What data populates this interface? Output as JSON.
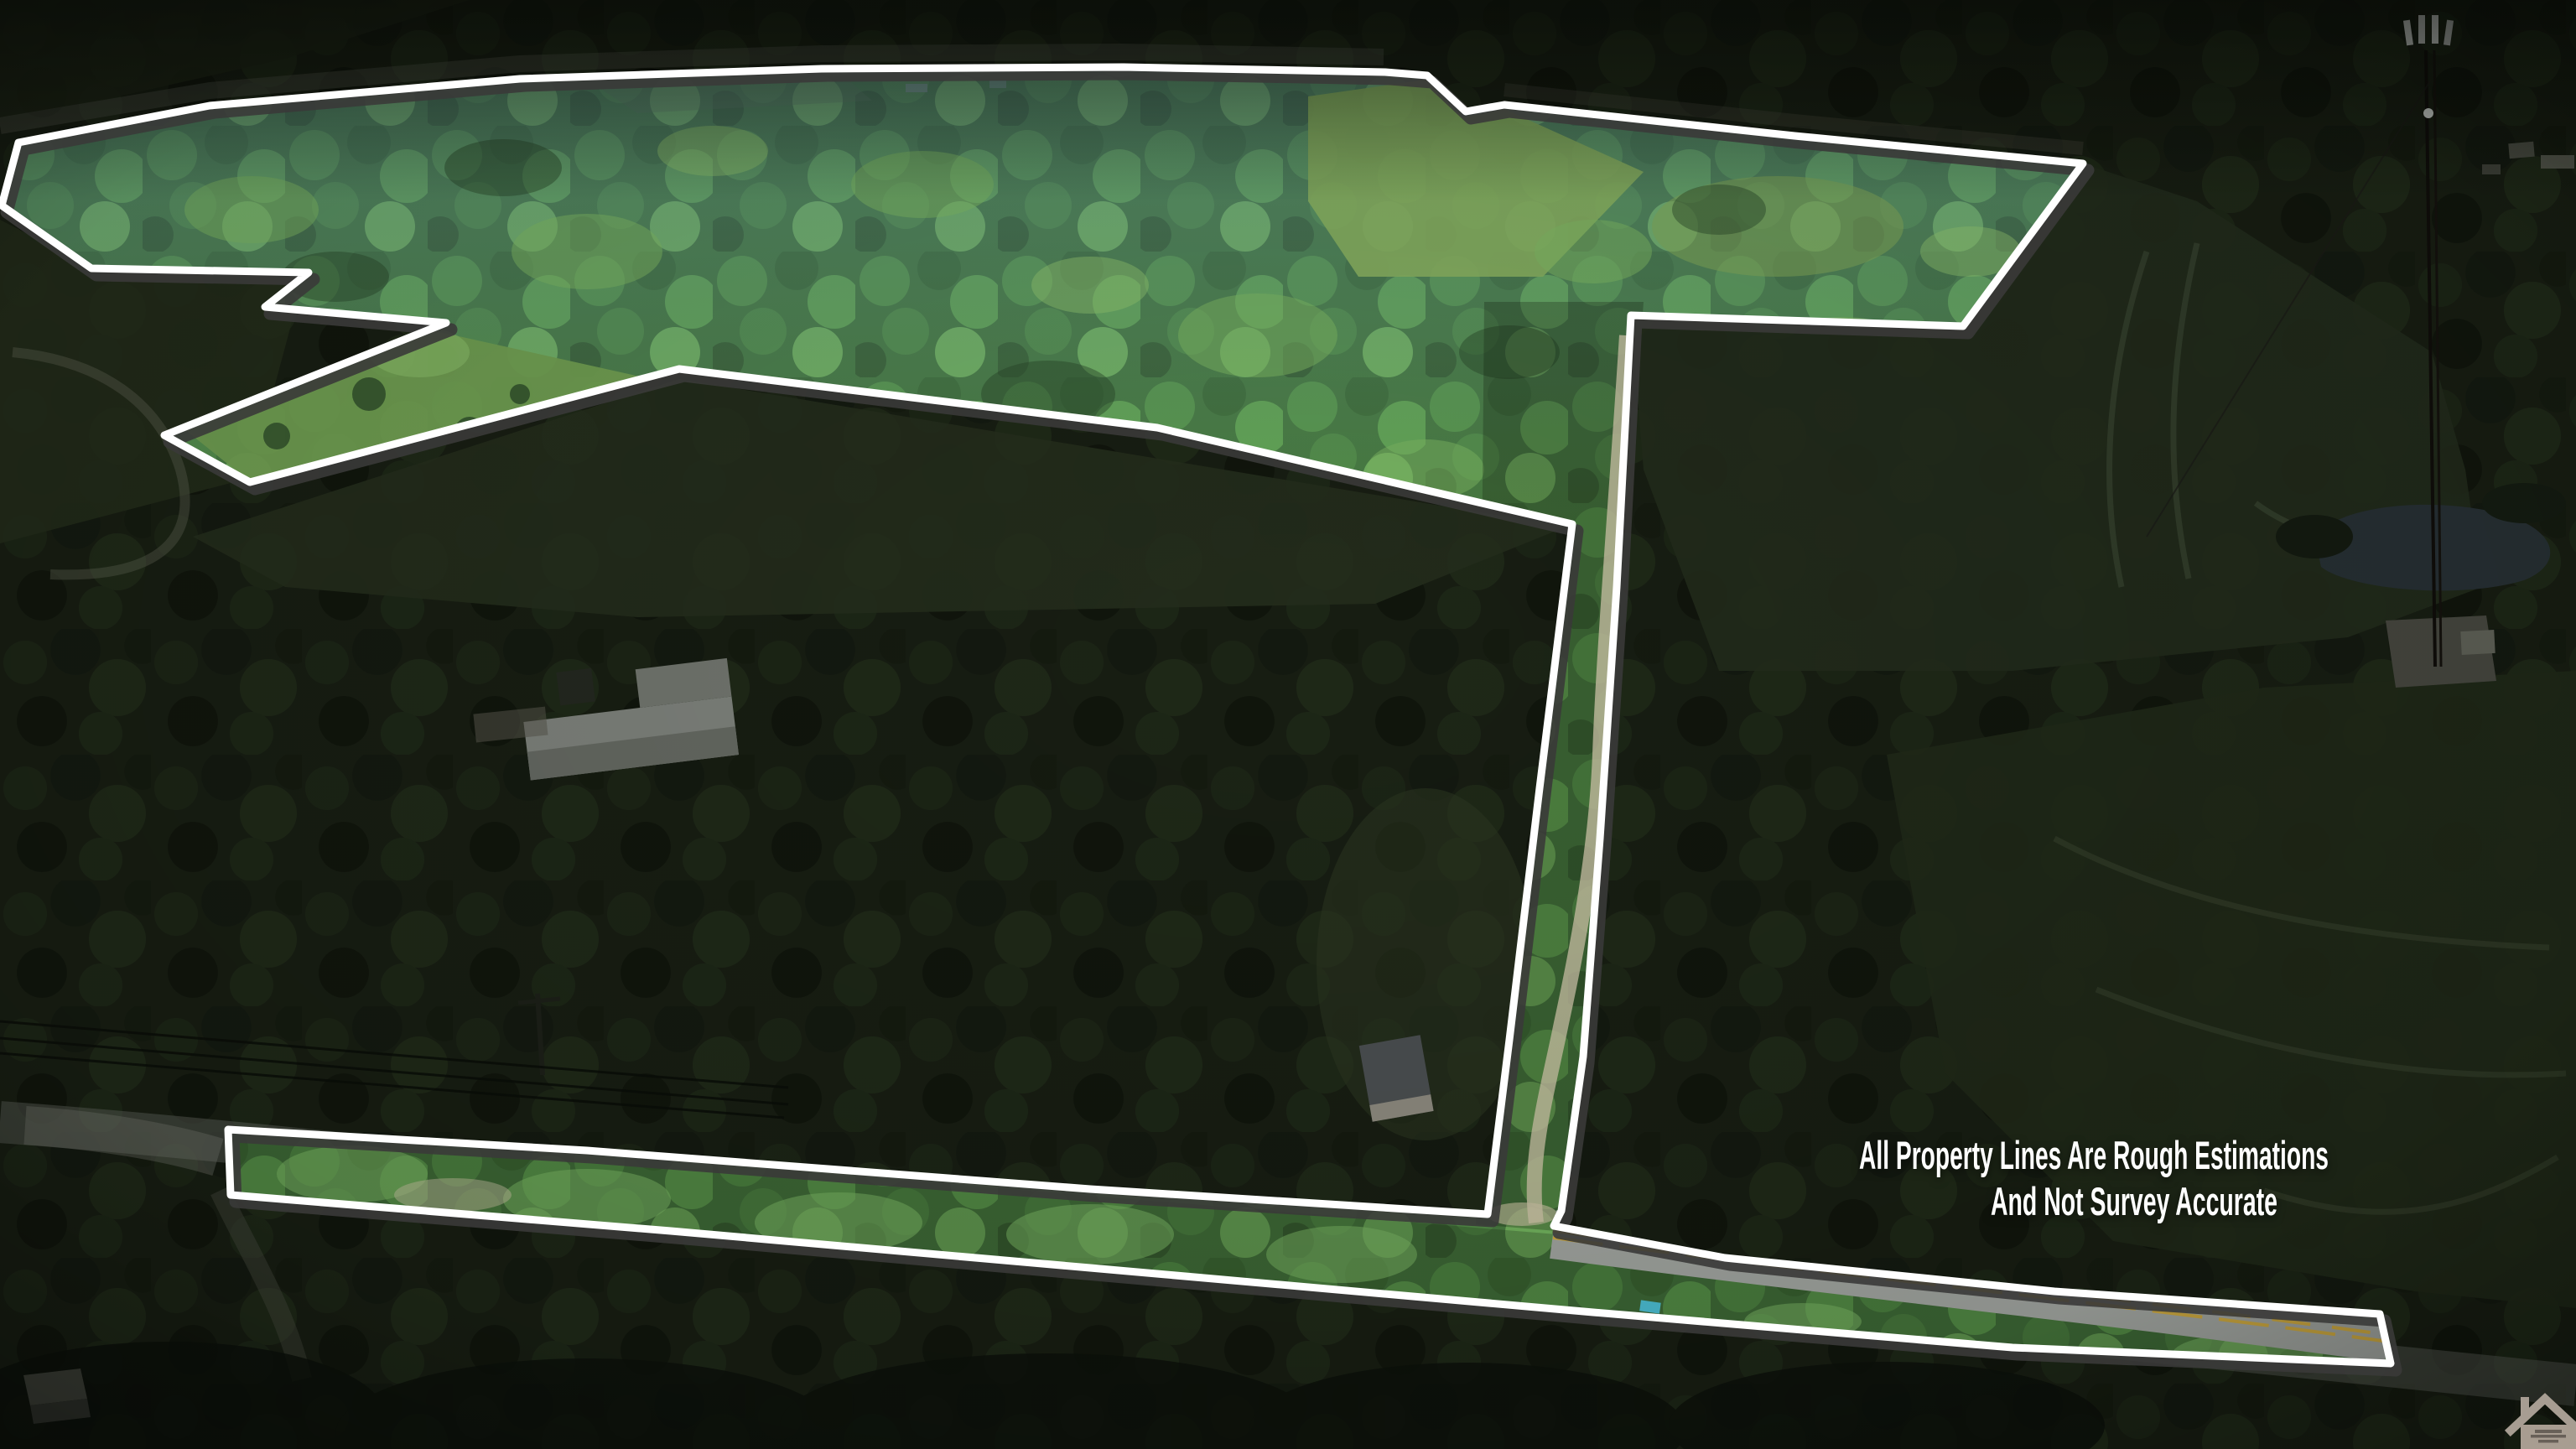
{
  "page": {
    "type": "aerial-drone-photo",
    "purpose": "real-estate listing photo with property boundary overlay",
    "highlight_style": "property interior shown bright, surrounding land darkened"
  },
  "overlay": {
    "disclaimer_line1": "All Property Lines Are Rough Estimations",
    "disclaimer_line2": "And Not Survey Accurate",
    "text_color": "#ffffff"
  },
  "boundary": {
    "line_color": "#ffffff",
    "shadow_color": "#3a3a38"
  },
  "road": {
    "surface_color": "#9ca09b",
    "center_line_color": "#c7a43e",
    "center_line_style": "double-yellow"
  },
  "logo": {
    "icon": "house-outline-icon",
    "color": "#a89d91",
    "text_legible": false
  },
  "scene": {
    "landcover": [
      "forest",
      "hay fields",
      "crop fields",
      "pond"
    ],
    "features": [
      "two-lane road",
      "gravel driveway",
      "farm buildings",
      "house",
      "utility pole",
      "power lines",
      "cell tower",
      "tower equipment pad",
      "small shed"
    ]
  },
  "palette": {
    "bright_forest": "#4a7f46",
    "dark_forest": "#171d12",
    "bright_meadow": "#83aa5d",
    "water": "#262f33",
    "asphalt_dark": "#5a5d56"
  }
}
